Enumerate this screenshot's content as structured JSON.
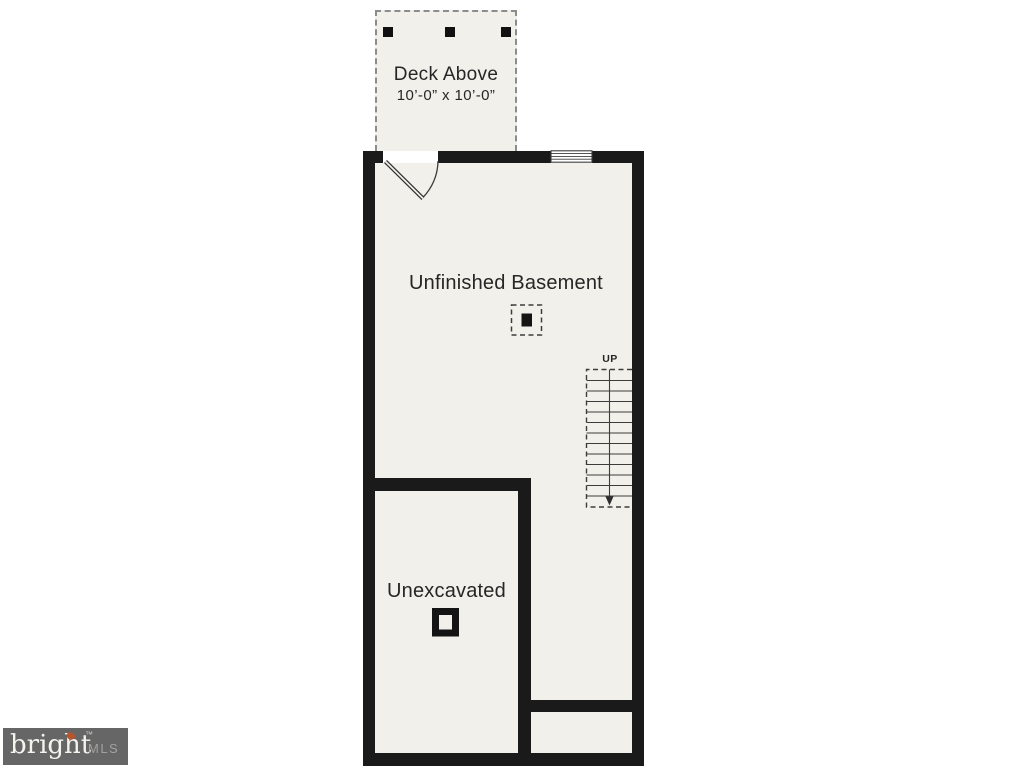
{
  "plan": {
    "deck": {
      "label": "Deck Above",
      "dimensions": "10’-0” x 10’-0”"
    },
    "basement": {
      "label": "Unfinished Basement"
    },
    "stairs": {
      "direction_label": "UP"
    },
    "unexcavated": {
      "label": "Unexcavated"
    }
  },
  "watermark": {
    "brand": "bright",
    "trademark": "™",
    "suffix": "MLS"
  },
  "colors": {
    "floor": "#f2f0ea",
    "wall": "#1a1a1a",
    "dashed_line": "#8c8c8c",
    "symbol_line": "#3c3c3c",
    "label_text": "#262626",
    "watermark_bg": "#666666",
    "watermark_brand": "#f5f3ee",
    "watermark_suffix": "#a3a19e",
    "flame": "#b7562e"
  }
}
